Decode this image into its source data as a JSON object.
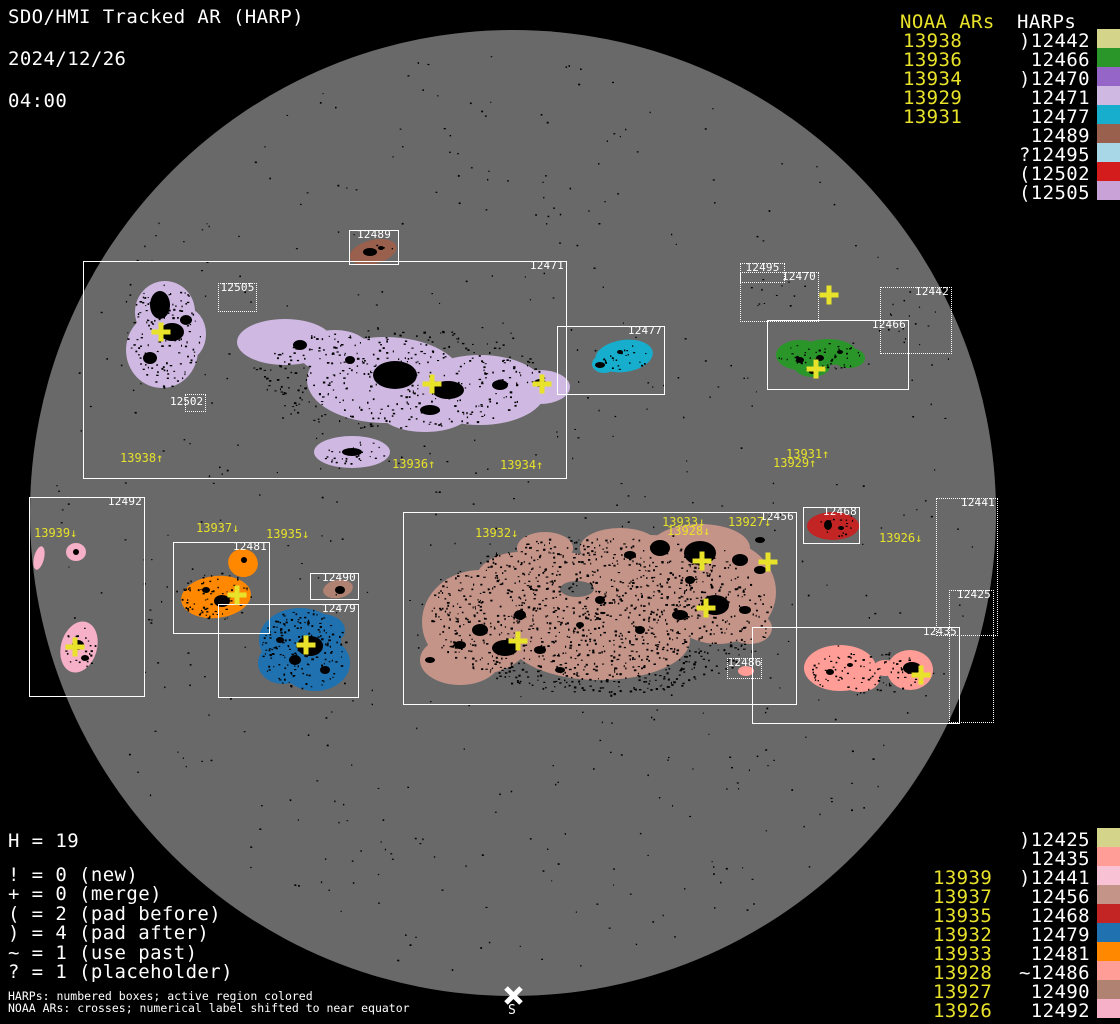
{
  "title": {
    "line1": "SDO/HMI Tracked AR (HARP)",
    "date": "2024/12/26",
    "time": "04:00"
  },
  "legend_top": {
    "noaa_header": "NOAA ARs",
    "harps_header": "HARPs",
    "noaa": [
      "13938",
      "13936",
      "13934",
      "13929",
      "13931"
    ],
    "harps": [
      ")12442",
      "12466",
      ")12470",
      "12471",
      "12477",
      "12489",
      "?12495",
      "(12502",
      "(12505"
    ]
  },
  "legend_bottom": {
    "noaa": [
      "13939",
      "13937",
      "13935",
      "13932",
      "13933",
      "13928",
      "13927",
      "13926"
    ],
    "harps": [
      ")12425",
      "12435",
      ")12441",
      "12456",
      "12468",
      "12479",
      "12481",
      "~12486",
      "12490",
      "12492"
    ]
  },
  "stats": {
    "h_count": "H = 19",
    "lines": "! = 0 (new)\n+ = 0 (merge)\n( = 2 (pad before)\n) = 4 (pad after)\n~ = 1 (use past)\n? = 1 (placeholder)"
  },
  "footer": {
    "line1": "HARPs: numbered boxes; active region colored",
    "line2": "NOAA ARs: crosses; numerical label shifted to near equator"
  },
  "south_label": "S",
  "boxes": {
    "b12471": "12471",
    "b12477": "12477",
    "b12466": "12466",
    "b12489": "12489",
    "b12468": "12468",
    "b12456": "12456",
    "b12492": "12492",
    "b12481": "12481",
    "b12490": "12490",
    "b12479": "12479",
    "b12435": "12435",
    "d12505": "12505",
    "d12502": "12502",
    "d12495": "12495",
    "d12470": "12470",
    "d12442": "12442",
    "d12441": "12441",
    "d12425": "12425",
    "d12486": "12486"
  },
  "ar_labels": {
    "l13938": "13938↑",
    "l13936": "13936↑",
    "l13934": "13934↑",
    "l13931": "13931↑",
    "l13929": "13929↑",
    "l13939": "13939↓",
    "l13937": "13937↓",
    "l13935": "13935↓",
    "l13932": "13932↓",
    "l13933": "13933↓",
    "l13928": "13928↓",
    "l13927": "13927↓",
    "l13926": "13926↓"
  },
  "colors": {
    "background": "#000000",
    "disk_gray": "#696969",
    "box_white": "#ffffff",
    "noaa_yellow": "#e8e22a",
    "h12425": "#d4d58a",
    "h12435": "#ff9d96",
    "h12441": "#f8c2d4",
    "h12442": "#d4d58a",
    "h12456": "#c59488",
    "h12466": "#2a962a",
    "h12468": "#c32424",
    "h12470": "#9565c8",
    "h12471": "#cfb9e2",
    "h12477": "#17aece",
    "h12479": "#1f71b0",
    "h12481": "#ff8800",
    "h12486": "#ff9d96",
    "h12489": "#98604d",
    "h12490": "#b08272",
    "h12492": "#f6b0c8",
    "h12495": "#a8d8e8",
    "h12502": "#d41c1c",
    "h12505": "#c9a2d8"
  }
}
